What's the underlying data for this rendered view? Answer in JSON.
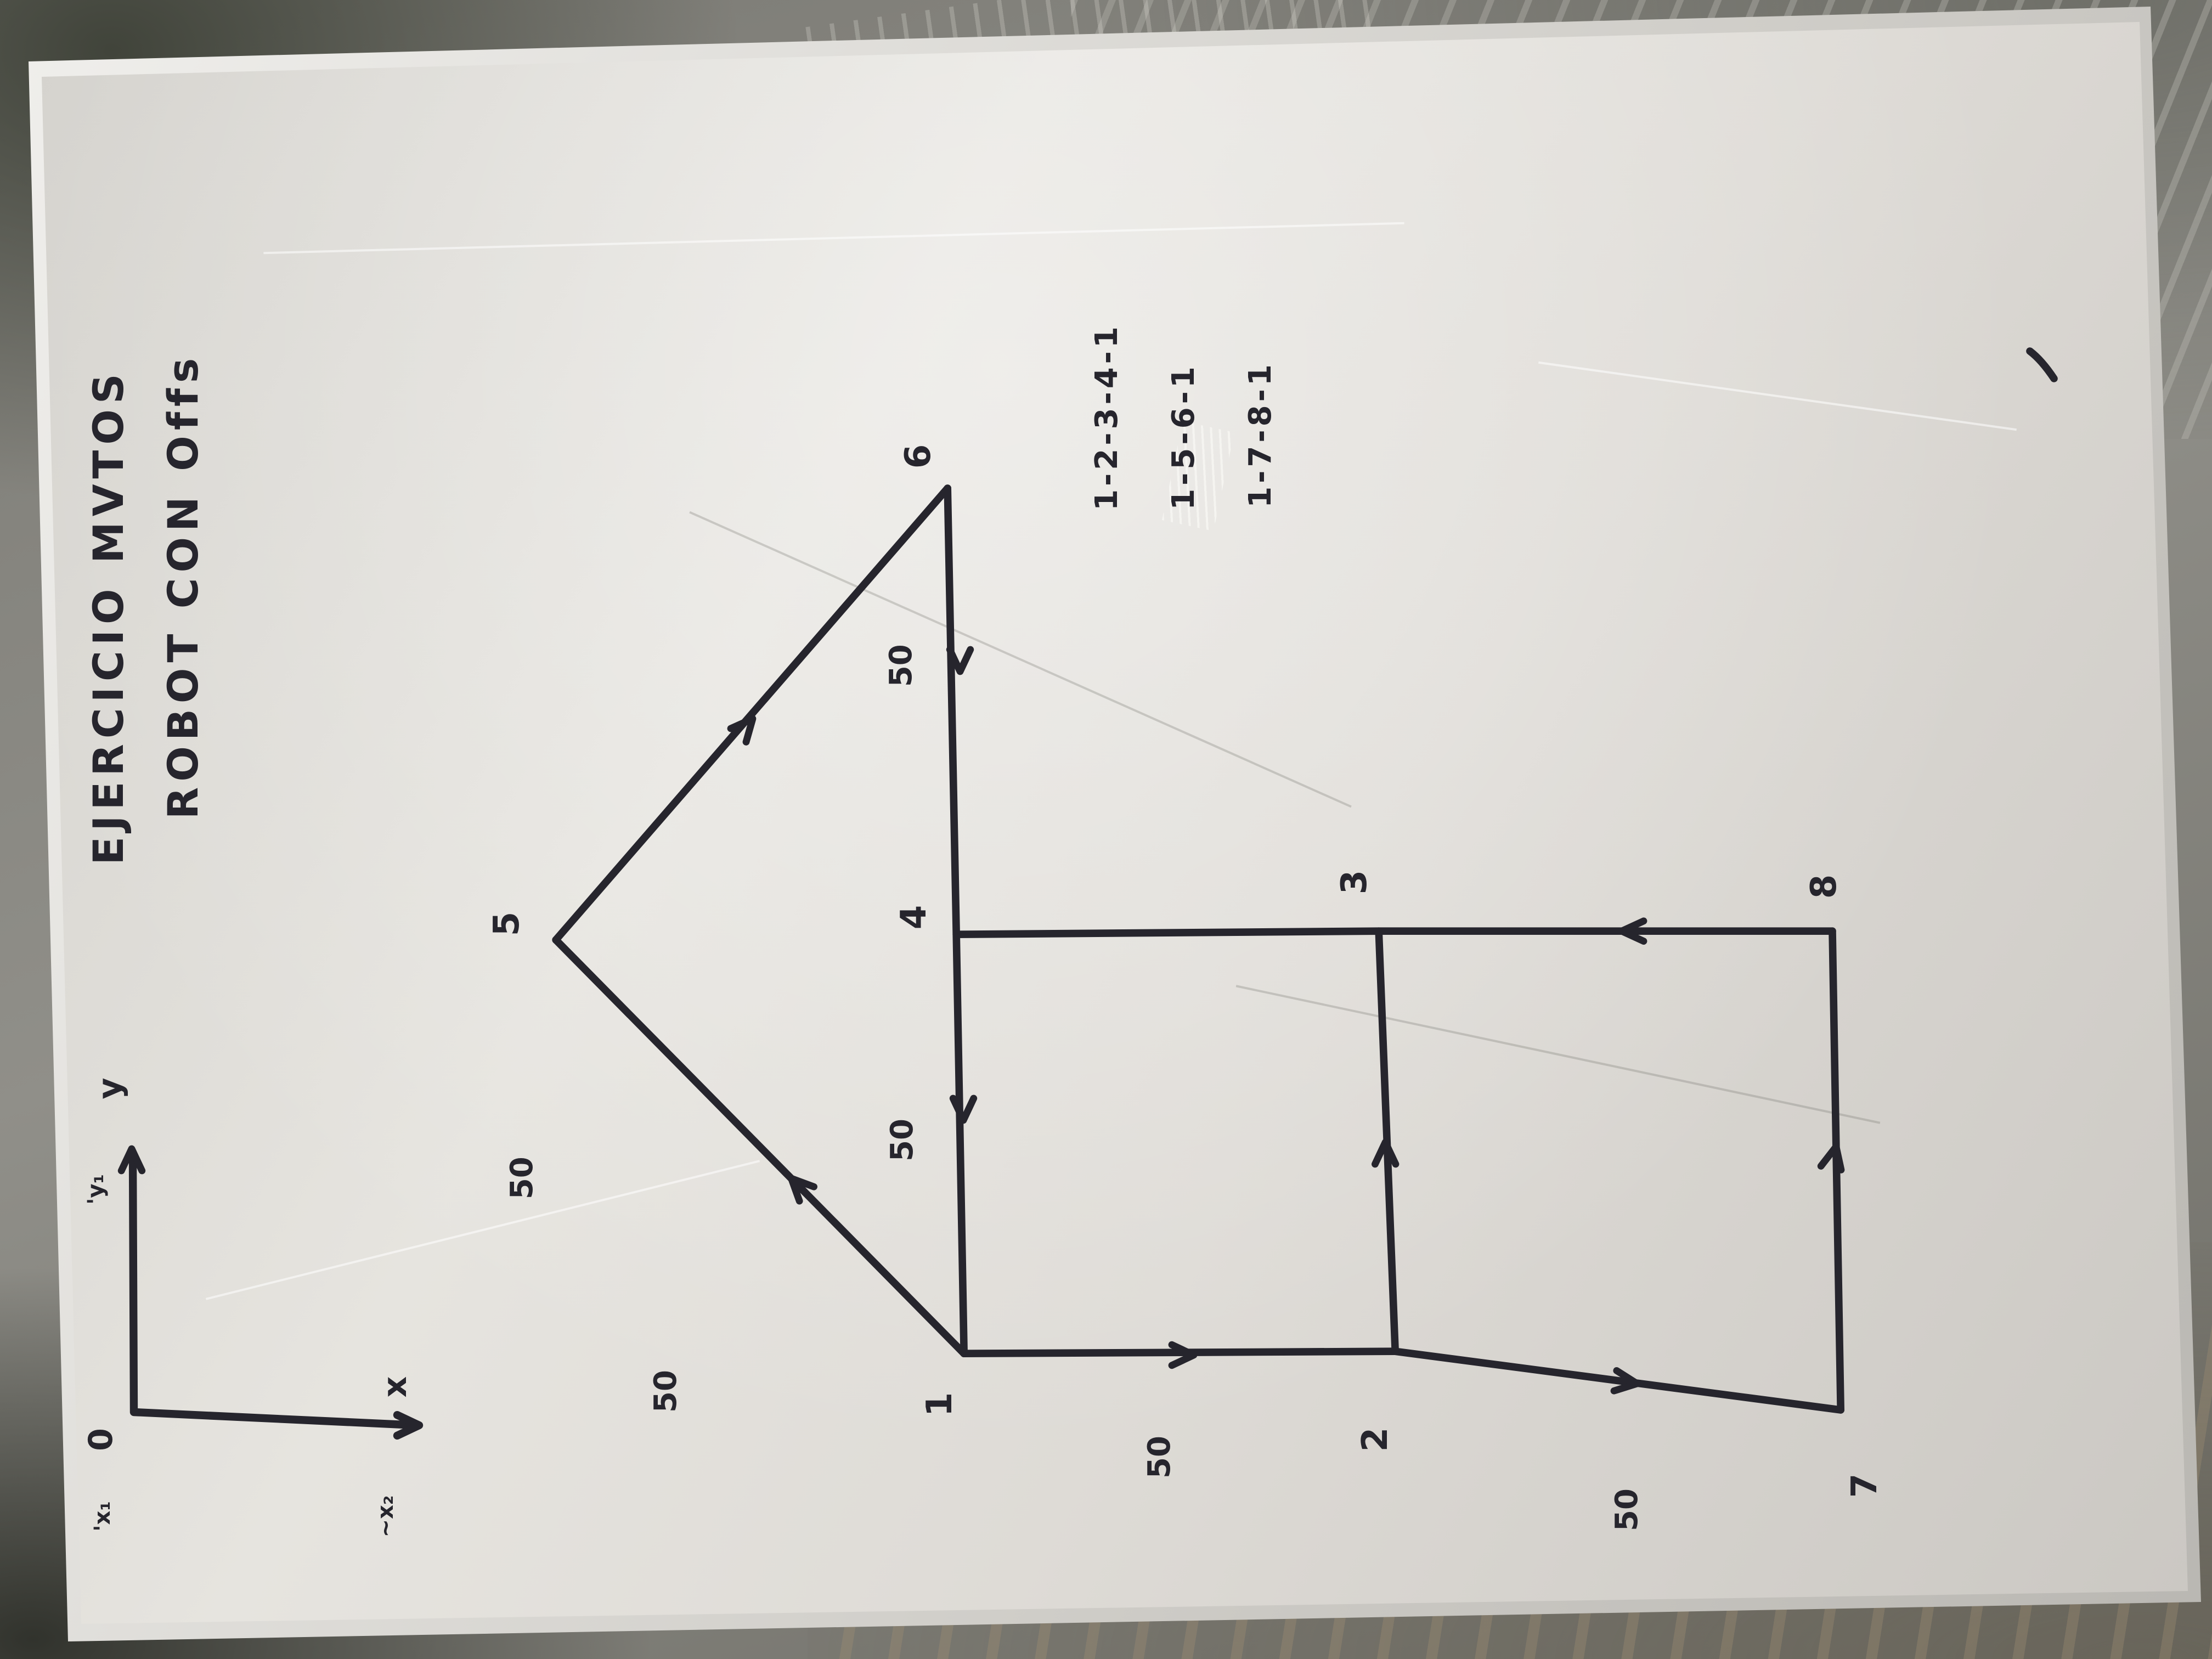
{
  "colors": {
    "marker": "#26252d",
    "plate_light": "#e6e4df",
    "plate_dark": "#cac7c2",
    "background_concrete": "#8f8e88"
  },
  "title": {
    "line1": "EJERCICIO MVTOS",
    "line2": "ROBOT CON Offs"
  },
  "sequences": {
    "seq1": "1-2-3-4-1",
    "seq2": "1-5-6-1",
    "seq3": "1-7-8-1"
  },
  "axis": {
    "y": "y",
    "y1": "'y₁",
    "origin": "0",
    "x": "x",
    "x1": "'x₁",
    "x2": "~x₂"
  },
  "points": {
    "p1": "1",
    "p2": "2",
    "p3": "3",
    "p4": "4",
    "p5": "5",
    "p6": "6",
    "p7": "7",
    "p8": "8"
  },
  "distances": {
    "d_6_4": "50",
    "d_4_1": "50",
    "d_5_1_upper": "50",
    "d_5_1_lower": "50",
    "d_1_2": "50",
    "d_2_7": "50"
  }
}
